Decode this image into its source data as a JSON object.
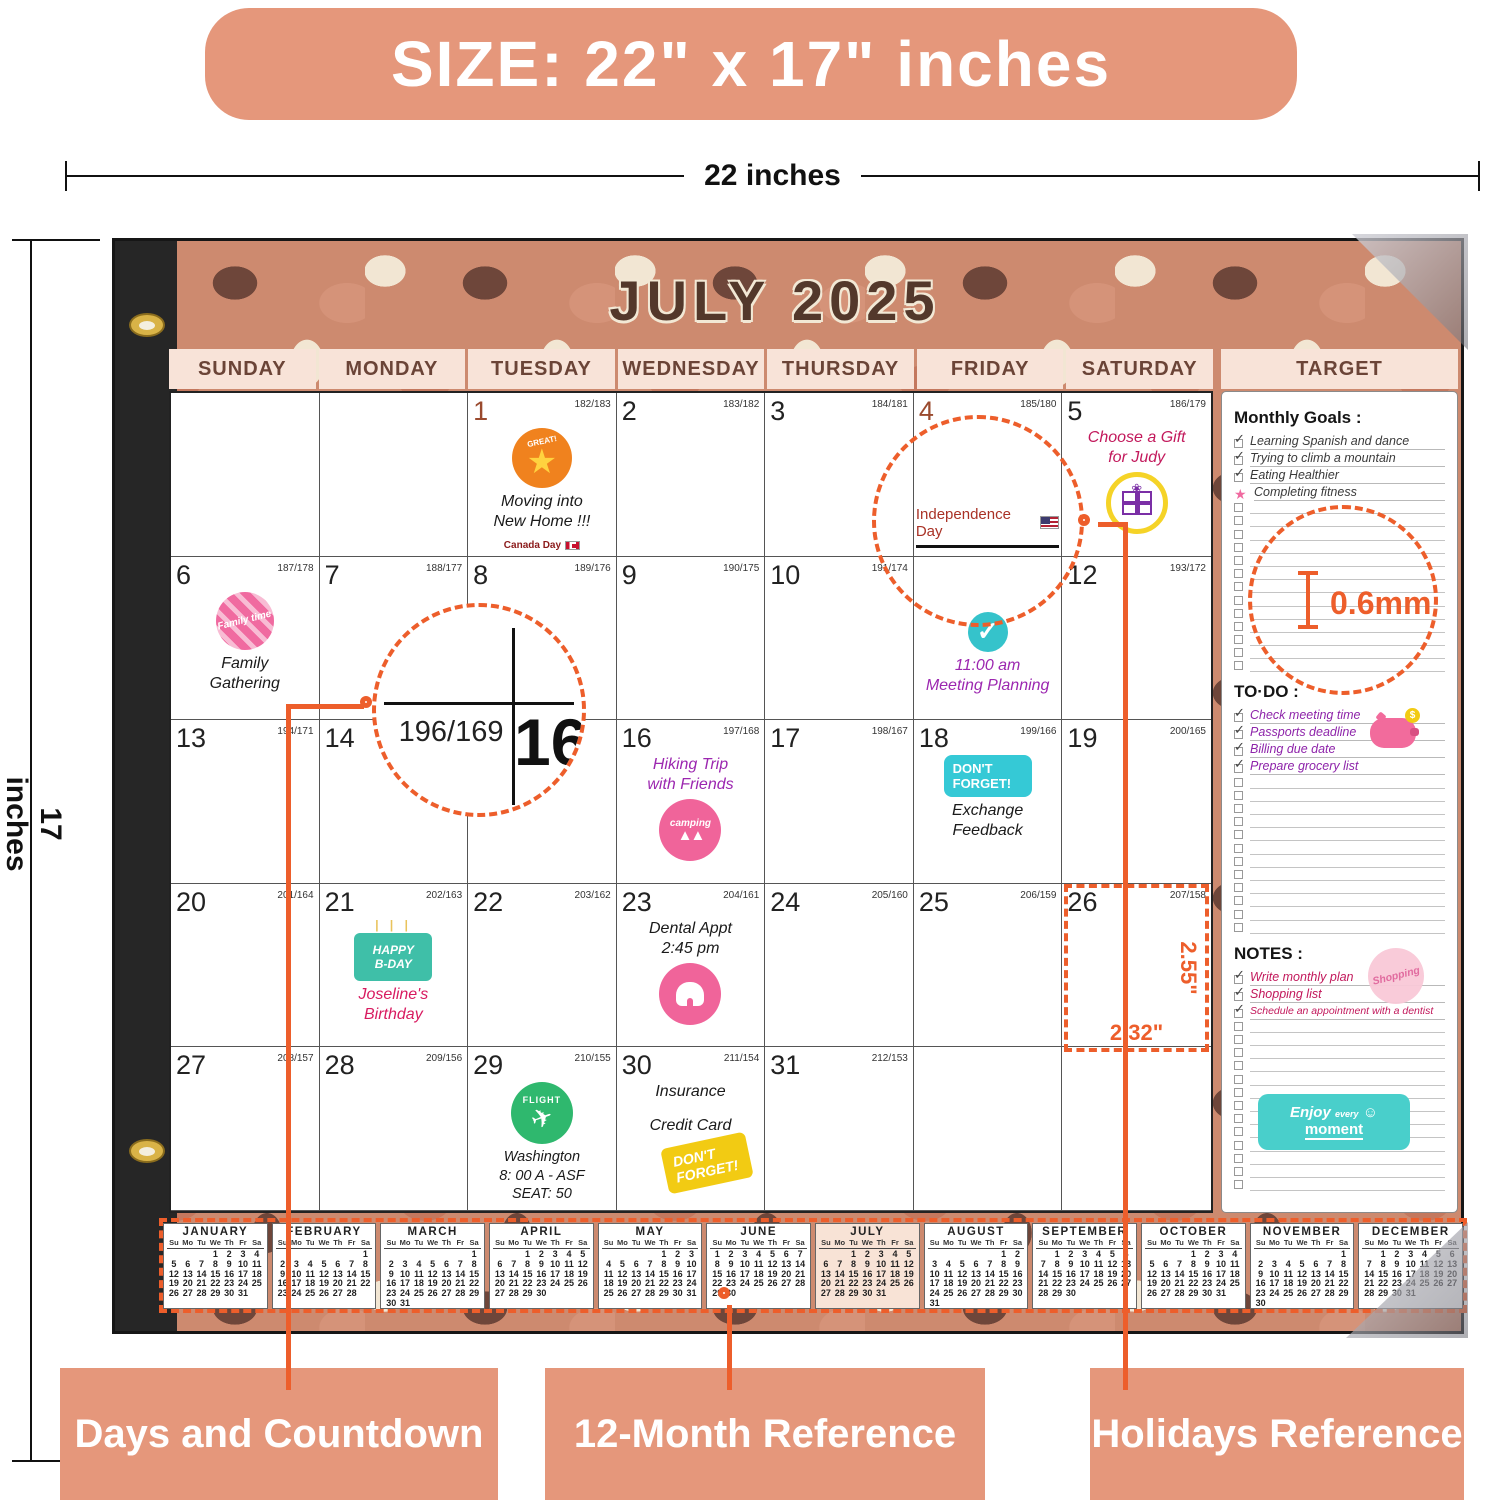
{
  "banner": {
    "text": "SIZE: 22\" x 17\" inches"
  },
  "dimension_labels": {
    "width": "22 inches",
    "height": "17 inches"
  },
  "calendar": {
    "title": "JULY 2025",
    "day_headers": [
      "SUNDAY",
      "MONDAY",
      "TUESDAY",
      "WEDNESDAY",
      "THURSDAY",
      "FRIDAY",
      "SATURDAY"
    ],
    "target_header": "TARGET",
    "weeks": [
      [
        {},
        {},
        {
          "d": "1",
          "red": true,
          "c": "182/183",
          "sticker": "great",
          "sticker_first": true,
          "note": [
            "Moving into",
            "New Home !!!"
          ],
          "holiday_ca": "Canada Day"
        },
        {
          "d": "2",
          "c": "183/182"
        },
        {
          "d": "3",
          "c": "184/181"
        },
        {
          "d": "4",
          "red": true,
          "c": "185/180",
          "holiday_us": "Independence Day"
        },
        {
          "d": "5",
          "c": "186/179",
          "note": [
            "Choose a Gift",
            "for Judy"
          ],
          "note_color": "#C2185B",
          "sticker": "gift"
        }
      ],
      [
        {
          "d": "6",
          "c": "187/178",
          "sticker": "family",
          "sticker_first": true,
          "note": [
            "Family",
            "Gathering"
          ]
        },
        {
          "d": "7",
          "c": "188/177"
        },
        {
          "d": "8",
          "c": "189/176"
        },
        {
          "d": "9",
          "c": "190/175"
        },
        {
          "d": "10",
          "c": "191/174"
        },
        {
          "sticker": "check",
          "sticker_first": true,
          "note": [
            "11:00 am",
            "Meeting Planning"
          ],
          "note_color": "#9C27B0",
          "pad_top": 52
        },
        {
          "d": "12",
          "c": "193/172"
        }
      ],
      [
        {
          "d": "13",
          "c": "194/171"
        },
        {
          "d": "14"
        },
        {},
        {
          "d": "16",
          "c": "197/168",
          "note": [
            "Hiking Trip",
            "with Friends"
          ],
          "note_color": "#9C27B0",
          "sticker": "camping"
        },
        {
          "d": "17",
          "c": "198/167"
        },
        {
          "d": "18",
          "c": "199/166",
          "sticker": "df_teal",
          "sticker_first": true,
          "note": [
            "Exchange",
            "Feedback"
          ]
        },
        {
          "d": "19",
          "c": "200/165"
        }
      ],
      [
        {
          "d": "20",
          "c": "201/164"
        },
        {
          "d": "21",
          "c": "202/163",
          "sticker": "bday",
          "sticker_first": true,
          "note": [
            "Joseline's",
            "Birthday"
          ],
          "note_color": "#D81B60"
        },
        {
          "d": "22",
          "c": "203/162"
        },
        {
          "d": "23",
          "c": "204/161",
          "note": [
            "Dental Appt",
            "2:45 pm"
          ],
          "sticker": "tooth"
        },
        {
          "d": "24",
          "c": "205/160"
        },
        {
          "d": "25",
          "c": "206/159"
        },
        {
          "d": "26",
          "c": "207/158"
        }
      ],
      [
        {
          "d": "27",
          "c": "208/157"
        },
        {
          "d": "28",
          "c": "209/156"
        },
        {
          "d": "29",
          "c": "210/155",
          "sticker": "flight",
          "sticker_first": true,
          "note": [
            "Washington",
            "8: 00 A - ASF",
            "SEAT: 50"
          ],
          "note_small": true
        },
        {
          "d": "30",
          "c": "211/154",
          "note": [
            "Insurance",
            "Credit Card"
          ],
          "sticker": "df_yellow",
          "note_gap": true
        },
        {
          "d": "31",
          "c": "212/153"
        },
        {},
        {}
      ]
    ]
  },
  "sidebar": {
    "monthly_goals": {
      "title": "Monthly Goals :",
      "items": [
        {
          "text": "Learning Spanish and dance",
          "mark": "check"
        },
        {
          "text": "Trying to climb a mountain",
          "mark": "check"
        },
        {
          "text": "Eating Healthier",
          "mark": "check"
        },
        {
          "text": "Completing fitness",
          "mark": "star"
        }
      ],
      "empty_rows": 13
    },
    "todo": {
      "title": "TO·DO :",
      "items": [
        {
          "text": "Check meeting time",
          "mark": "check"
        },
        {
          "text": "Passports deadline",
          "mark": "check"
        },
        {
          "text": "Billing due date",
          "mark": "check"
        },
        {
          "text": "Prepare grocery list",
          "mark": "check"
        }
      ],
      "empty_rows": 12
    },
    "notes": {
      "title": "NOTES :",
      "items": [
        {
          "text": "Write monthly plan",
          "mark": "check"
        },
        {
          "text": "Shopping list",
          "mark": "check"
        },
        {
          "text": "Schedule an appointment with a dentist",
          "mark": "check",
          "long": true
        }
      ],
      "empty_rows": 13
    },
    "stickers": {
      "piggy_coin": "$",
      "shopping": "Shopping",
      "enjoy_line1": "Enjoy",
      "enjoy_line1b": "every",
      "enjoy_smiley": "☺",
      "enjoy_line2": "moment"
    }
  },
  "stickers": {
    "great": "GREAT!",
    "family": "Family time",
    "camping": "camping",
    "df_teal_1": "DON'T",
    "df_teal_2": "FORGET!",
    "bday_1": "HAPPY",
    "bday_2": "B-DAY",
    "flight": "FLIGHT",
    "df_yellow_1": "DON'T",
    "df_yellow_2": "FORGET!",
    "check_mark": "✓",
    "plane": "✈",
    "star": "★"
  },
  "annotations": {
    "paper_thickness": "0.6mm",
    "magnifier_countdown": "196/169",
    "magnifier_date": "16",
    "cell_width": "2.32\"",
    "cell_height": "2.55\""
  },
  "mini_calendar": {
    "dow": [
      "Su",
      "Mo",
      "Tu",
      "We",
      "Th",
      "Fr",
      "Sa"
    ],
    "months": [
      {
        "name": "JANUARY",
        "start": 3,
        "days": 31
      },
      {
        "name": "FEBRUARY",
        "start": 6,
        "days": 28
      },
      {
        "name": "MARCH",
        "start": 6,
        "days": 31
      },
      {
        "name": "APRIL",
        "start": 2,
        "days": 30
      },
      {
        "name": "MAY",
        "start": 4,
        "days": 31
      },
      {
        "name": "JUNE",
        "start": 0,
        "days": 30
      },
      {
        "name": "JULY",
        "start": 2,
        "days": 31,
        "highlight": true
      },
      {
        "name": "AUGUST",
        "start": 5,
        "days": 31
      },
      {
        "name": "SEPTEMBER",
        "start": 1,
        "days": 30
      },
      {
        "name": "OCTOBER",
        "start": 3,
        "days": 31
      },
      {
        "name": "NOVEMBER",
        "start": 6,
        "days": 30
      },
      {
        "name": "DECEMBER",
        "start": 1,
        "days": 31
      }
    ]
  },
  "callout_labels": [
    "Days and Countdown",
    "12-Month Reference",
    "Holidays Reference"
  ]
}
